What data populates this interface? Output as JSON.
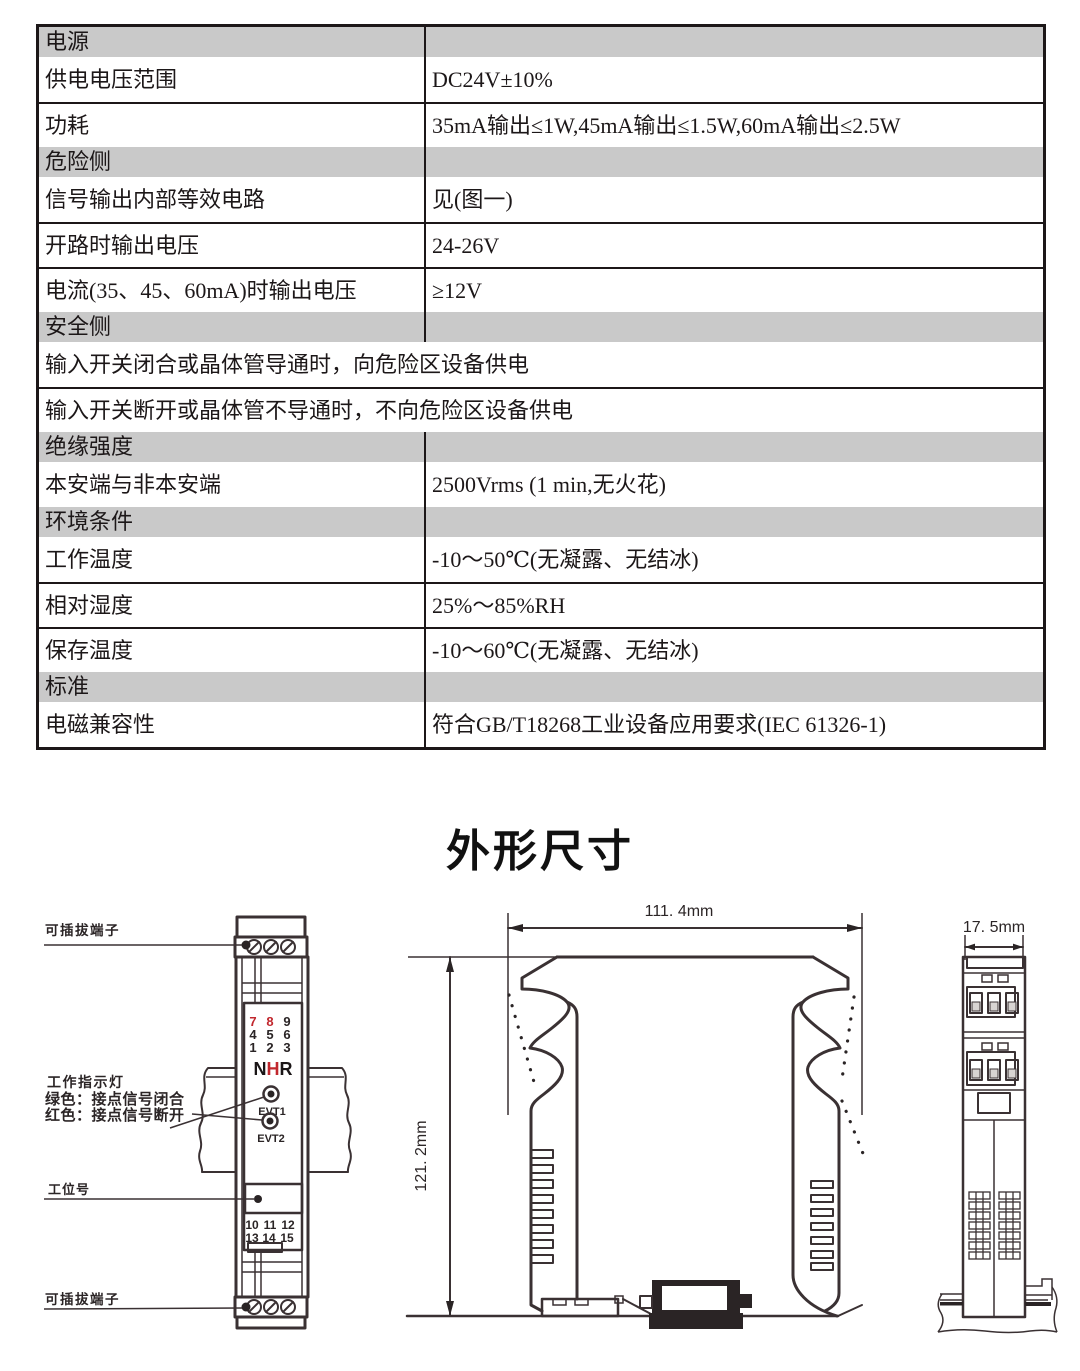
{
  "table": {
    "rows": [
      {
        "type": "header",
        "label": "电源"
      },
      {
        "type": "row",
        "label": "供电电压范围",
        "value": "DC24V±10%"
      },
      {
        "type": "row",
        "label": "功耗",
        "value": "35mA输出≤1W,45mA输出≤1.5W,60mA输出≤2.5W"
      },
      {
        "type": "header",
        "label": "危险侧"
      },
      {
        "type": "row",
        "label": "信号输出内部等效电路",
        "value": "见(图一)"
      },
      {
        "type": "row",
        "label": "开路时输出电压",
        "value": "24-26V"
      },
      {
        "type": "row",
        "label": "电流(35、45、60mA)时输出电压",
        "value": "≥12V"
      },
      {
        "type": "header",
        "label": "安全侧"
      },
      {
        "type": "span",
        "label": "输入开关闭合或晶体管导通时，向危险区设备供电"
      },
      {
        "type": "span",
        "label": "输入开关断开或晶体管不导通时，不向危险区设备供电"
      },
      {
        "type": "header",
        "label": "绝缘强度"
      },
      {
        "type": "row",
        "label": "本安端与非本安端",
        "value": "2500Vrms (1 min,无火花)"
      },
      {
        "type": "header",
        "label": "环境条件"
      },
      {
        "type": "row",
        "label": "工作温度",
        "value": "-10～50℃(无凝露、无结冰)"
      },
      {
        "type": "row",
        "label": "相对湿度",
        "value": "25%～85%RH"
      },
      {
        "type": "row",
        "label": "保存温度",
        "value": "-10～60℃(无凝露、无结冰)"
      },
      {
        "type": "header",
        "label": "标准"
      },
      {
        "type": "row",
        "label": "电磁兼容性",
        "value": "符合GB/T18268工业设备应用要求(IEC 61326-1)"
      }
    ]
  },
  "section_title": "外形尺寸",
  "diagrams": {
    "front_view": {
      "label_top_terminal": "可插拔端子",
      "label_indicator_title": "工作指示灯",
      "label_indicator_green": "绿色：接点信号闭合",
      "label_indicator_red": "红色：接点信号断开",
      "label_tag": "工位号",
      "label_bottom_terminal": "可插拔端子",
      "terminal_grid": [
        [
          "7",
          "8",
          "9"
        ],
        [
          "4",
          "5",
          "6"
        ],
        [
          "1",
          "2",
          "3"
        ]
      ],
      "logo": {
        "n": "N",
        "h": "H",
        "r": "R"
      },
      "led1_label": "EVT1",
      "led2_label": "EVT2",
      "bottom_grid": [
        [
          "10",
          "11",
          "12"
        ],
        [
          "13",
          "14",
          "15"
        ]
      ]
    },
    "side_view": {
      "width_label": "111. 4mm",
      "height_label": "121. 2mm"
    },
    "end_view": {
      "width_label": "17. 5mm"
    },
    "colors": {
      "line": "#3a3133",
      "red": "#c1272d",
      "header_gray": "#c9c9c9"
    }
  }
}
